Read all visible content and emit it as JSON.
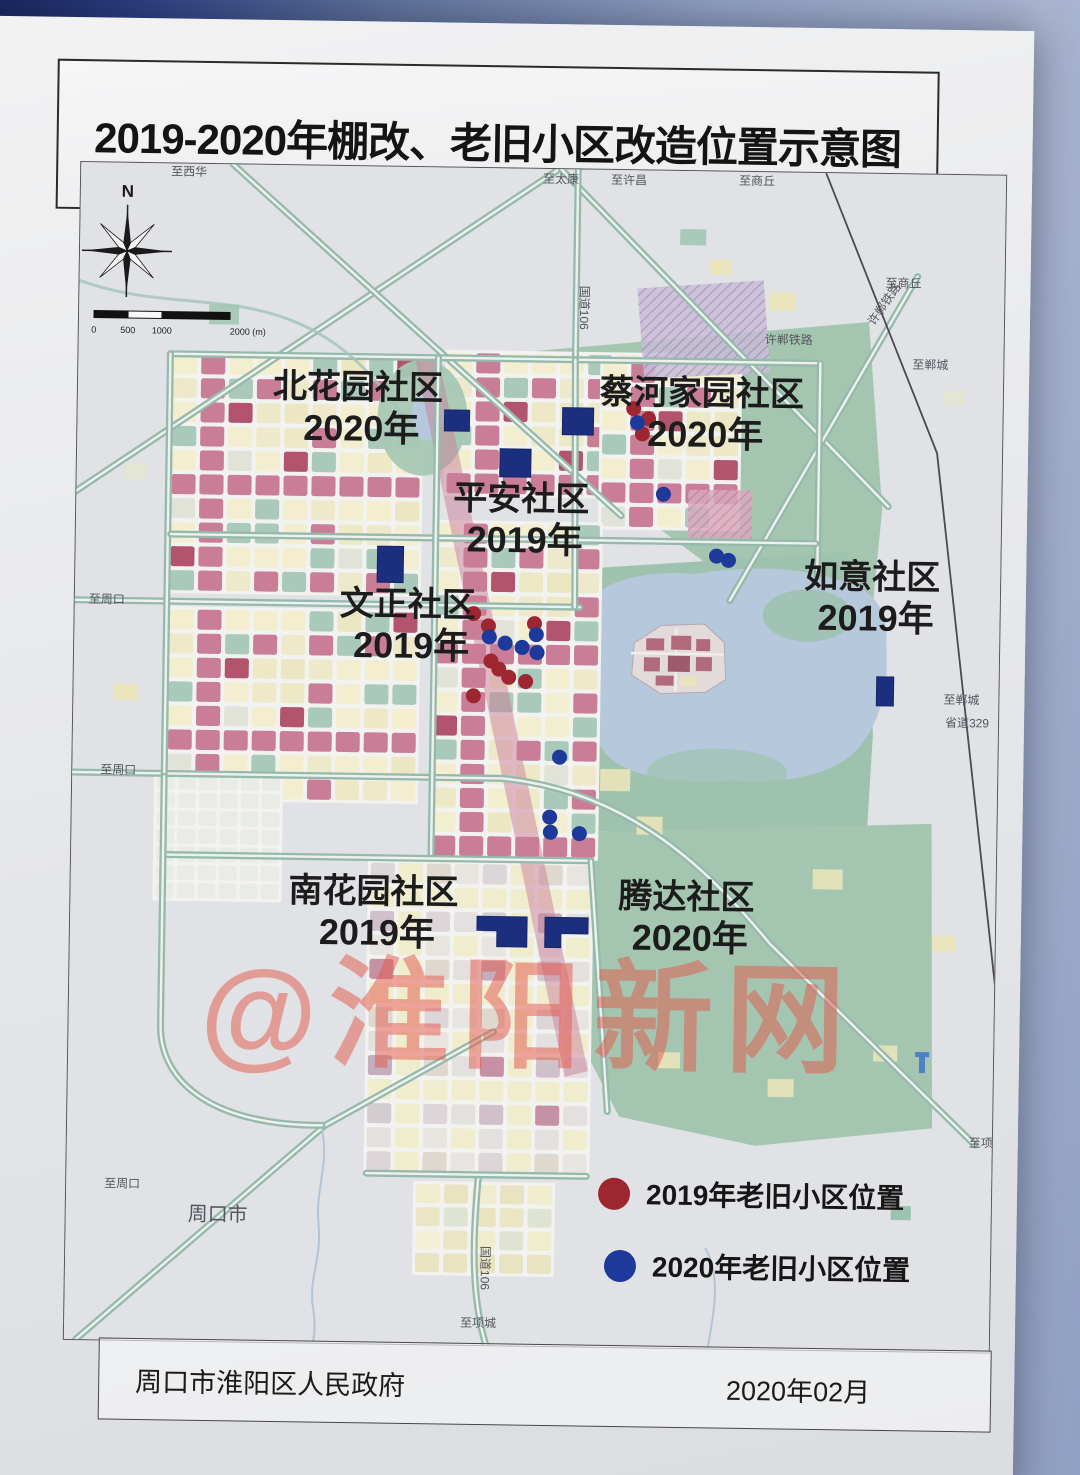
{
  "title": "2019-2020年棚改、老旧小区改造位置示意图",
  "watermark": "@淮阳新网",
  "footer": {
    "left": "周口市淮阳区人民政府",
    "right": "2020年02月"
  },
  "compass": {
    "label": "N"
  },
  "scale_bar": {
    "ticks": [
      "0",
      "500",
      "1000",
      "2000 (m)"
    ]
  },
  "legend": [
    {
      "color": "#9e2630",
      "label": "2019年老旧小区位置"
    },
    {
      "color": "#1d3a9b",
      "label": "2020年老旧小区位置"
    }
  ],
  "map": {
    "communities": [
      {
        "name": "北花园社区",
        "year": "2020年",
        "x": 280,
        "y": 232
      },
      {
        "name": "蔡河家园社区",
        "year": "2020年",
        "x": 624,
        "y": 233
      },
      {
        "name": "平安社区",
        "year": "2019年",
        "x": 445,
        "y": 341
      },
      {
        "name": "如意社区",
        "year": "2019年",
        "x": 797,
        "y": 414
      },
      {
        "name": "文正社区",
        "year": "2019年",
        "x": 333,
        "y": 448
      },
      {
        "name": "南花园社区",
        "year": "2019年",
        "x": 303,
        "y": 735
      },
      {
        "name": "腾达社区",
        "year": "2020年",
        "x": 616,
        "y": 736
      }
    ],
    "road_labels": [
      {
        "text": "至西华",
        "x": 90,
        "y": 12
      },
      {
        "text": "至太康",
        "x": 462,
        "y": 14
      },
      {
        "text": "至许昌",
        "x": 530,
        "y": 14
      },
      {
        "text": "至商丘",
        "x": 658,
        "y": 13
      },
      {
        "text": "至商丘",
        "x": 806,
        "y": 113
      },
      {
        "text": "许郸铁路",
        "x": 795,
        "y": 152,
        "rot": -56
      },
      {
        "text": "至郸城",
        "x": 834,
        "y": 194
      },
      {
        "text": "国道106",
        "x": 501,
        "y": 116,
        "rot": 90
      },
      {
        "text": "许郸铁路",
        "x": 686,
        "y": 171
      },
      {
        "text": "至郸城",
        "x": 870,
        "y": 528
      },
      {
        "text": "省道329",
        "x": 872,
        "y": 551
      },
      {
        "text": "至周口",
        "x": 14,
        "y": 440
      },
      {
        "text": "至周口",
        "x": 28,
        "y": 610
      },
      {
        "text": "至周口",
        "x": 38,
        "y": 1023
      },
      {
        "text": "周口市",
        "x": 122,
        "y": 1055,
        "size": 20
      },
      {
        "text": "国道106",
        "x": 416,
        "y": 1076,
        "rot": 90
      },
      {
        "text": "至项城",
        "x": 396,
        "y": 1157
      },
      {
        "text": "至项城",
        "x": 902,
        "y": 970
      }
    ],
    "dots_2019": [
      [
        399,
        445
      ],
      [
        414,
        457
      ],
      [
        460,
        454
      ],
      [
        417,
        492
      ],
      [
        425,
        500
      ],
      [
        435,
        508
      ],
      [
        452,
        512
      ],
      [
        400,
        527
      ],
      [
        556,
        238
      ],
      [
        571,
        248
      ],
      [
        565,
        263
      ]
    ],
    "dots_2020": [
      [
        415,
        468
      ],
      [
        431,
        474
      ],
      [
        448,
        478
      ],
      [
        462,
        465
      ],
      [
        463,
        483
      ],
      [
        487,
        587
      ],
      [
        478,
        647
      ],
      [
        479,
        662
      ],
      [
        508,
        663
      ],
      [
        641,
        384
      ],
      [
        653,
        388
      ],
      [
        587,
        323
      ],
      [
        560,
        252
      ]
    ],
    "renovation_areas": {
      "rects": [
        [
          367,
          242,
          25,
          21
        ],
        [
          485,
          238,
          31,
          27
        ],
        [
          423,
          280,
          31,
          28
        ],
        [
          302,
          379,
          26,
          36
        ],
        [
          803,
          502,
          17,
          29
        ]
      ],
      "polygons": [
        "407,747 457,747 457,777 427,777 427,761 407,761",
        "475,747 518,747 518,763 491,763 491,777 475,777"
      ]
    }
  }
}
